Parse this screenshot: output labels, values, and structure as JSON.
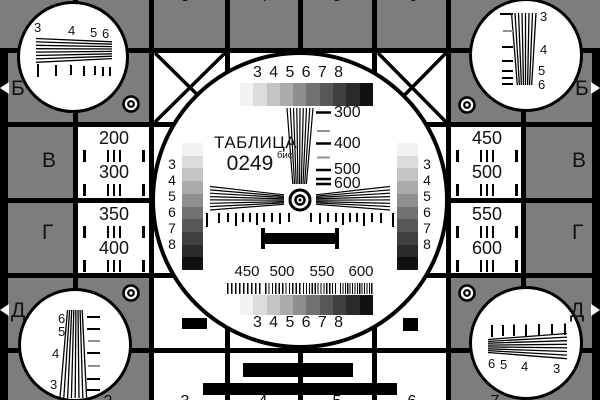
{
  "pattern": {
    "kind": "television-test-card",
    "title": {
      "word": "ТАБЛИЦА",
      "number": "0249",
      "suffix": "бис"
    }
  },
  "colors": {
    "background_gray": "#7d7d7d",
    "line_black": "#000000",
    "panel_white": "#ffffff",
    "dim_dash_gray": "#909090"
  },
  "grayscale_steps": [
    "#f2f2f2",
    "#dcdcdc",
    "#c4c4c4",
    "#ababab",
    "#8f8f8f",
    "#727272",
    "#585858",
    "#404040",
    "#2a2a2a",
    "#111111"
  ],
  "center": {
    "top_scale": [
      "3",
      "4",
      "5",
      "6",
      "7",
      "8"
    ],
    "bottom_scale": [
      "3",
      "4",
      "5",
      "6",
      "7",
      "8"
    ],
    "left_scale": [
      "3",
      "4",
      "5",
      "6",
      "7",
      "8"
    ],
    "right_scale": [
      "3",
      "4",
      "5",
      "6",
      "7",
      "8"
    ],
    "wedge_marks": [
      "300",
      "400",
      "500",
      "600"
    ],
    "burst_marks": [
      "450",
      "500",
      "550",
      "600"
    ]
  },
  "corners": {
    "top_left": [
      "3",
      "4",
      "5",
      "6"
    ],
    "top_right": [
      "3",
      "4",
      "5",
      "6"
    ],
    "bottom_left": [
      "6",
      "5",
      "4",
      "3"
    ],
    "bottom_right": [
      "6",
      "5",
      "4",
      "3"
    ]
  },
  "rows": {
    "left": [
      "Б",
      "В",
      "Г",
      "Д"
    ],
    "right": [
      "Б",
      "В",
      "Г",
      "Д"
    ]
  },
  "side_cells": {
    "left_top": [
      "200",
      "300"
    ],
    "left_bottom": [
      "350",
      "400"
    ],
    "right_top": [
      "450",
      "500"
    ],
    "right_bottom": [
      "550",
      "600"
    ]
  },
  "edge_numbers": {
    "top": [
      "3",
      "4",
      "5",
      "6"
    ],
    "bottom": [
      "2",
      "3",
      "4",
      "5",
      "6",
      "7"
    ]
  }
}
